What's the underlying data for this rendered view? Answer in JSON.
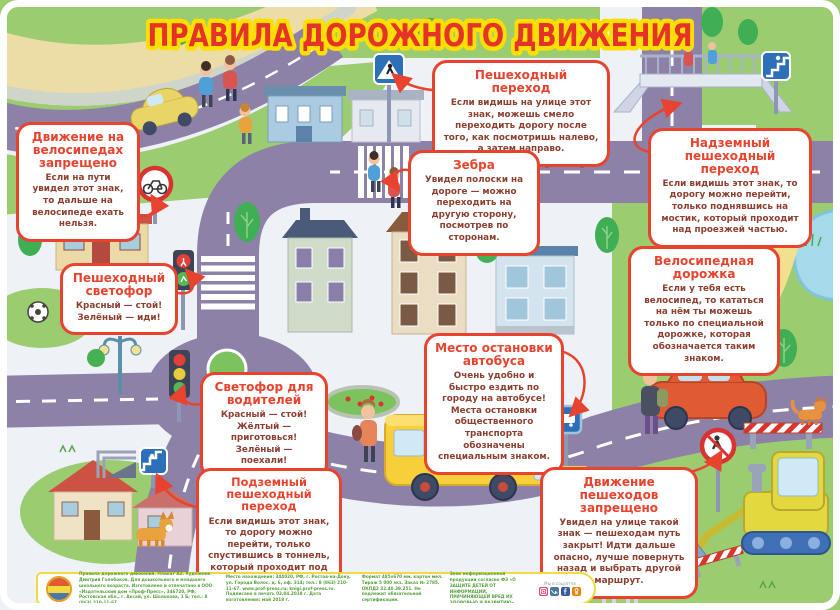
{
  "title": "ПРАВИЛА ДОРОЖНОГО ДВИЖЕНИЯ",
  "colors": {
    "accent_red": "#e8432e",
    "title_fill": "#e63329",
    "title_outline": "#ffdf00",
    "body_text": "#8c3f2f",
    "road": "#8d81a8",
    "grass": "#9bcc70",
    "footer_green": "#55a03c"
  },
  "callouts": {
    "no_bikes": {
      "title": "Движение на велосипедах запрещено",
      "body": "Если на пути увидел этот знак, то дальше на велосипеде ехать нельзя."
    },
    "crosswalk": {
      "title": "Пешеходный переход",
      "body": "Если видишь на улице этот знак, можешь смело переходить дорогу после того, как посмотришь налево, а затем направо."
    },
    "zebra": {
      "title": "Зебра",
      "body": "Увидел полоски на дороге — можно переходить на другую сторону, посмотрев по сторонам."
    },
    "overpass": {
      "title": "Надземный пешеходный переход",
      "body": "Если видишь этот знак, то дорогу можно перейти, только поднявшись на мостик, который проходит над проезжей частью."
    },
    "ped_light": {
      "title": "Пешеходный светофор",
      "body": "Красный — стой! Зелёный — иди!"
    },
    "bike_path": {
      "title": "Велосипедная дорожка",
      "body": "Если у тебя есть велосипед, то кататься на нём ты можешь только по специальной дорожке, которая обозначается таким знаком."
    },
    "bus_stop": {
      "title": "Место остановки автобуса",
      "body": "Очень удобно и быстро ездить по городу на автобусе! Места остановки общественного транспорта обозначены специальным знаком."
    },
    "driver_light": {
      "title": "Светофор для водителей",
      "body": "Красный — стой! Жёлтый — приготовься! Зелёный — поехали!"
    },
    "underpass": {
      "title": "Подземный пешеходный переход",
      "body": "Если видишь этот знак, то дорогу можно перейти, только спустившись в тоннель, который проходит под проезжей частью."
    },
    "no_peds": {
      "title": "Движение пешеходов запрещено",
      "body": "Увидел на улице такой знак — пешеходам путь закрыт! Идти дальше опасно, лучше повернуть назад и выбрать другой маршрут."
    }
  },
  "footer": {
    "col1": "Правила дорожного движения. Плакат А2. Художник Дмитрий Голобоков. Для дошкольного и младшего школьного возраста. Изготовлено и отпечатано в ООО «Издательский дом «Проф-Пресс», 346720, РФ, Ростовская обл., г. Аксай, ул. Шолохова, 1 Б; тел.: 8 (863) 210-11-67.",
    "col2": "Место нахождения: 344020, РФ, г. Ростов-на-Дону, ул. Города Волос, д. 6, оф. 314; тел.: 8 (863) 210-11-67. www.prof-press.ru; knigi.prof-press.ru. Подписано в печать 02.04.2018 г. Дата изготовления: май 2018 г.",
    "col3": "Формат 485х670 мм, картон мел. Тираж 5 000 экз. Заказ № 2785. ОКПД2 32.40.39.251. Не подлежит обязательной сертификации.",
    "col4": "Знак информационной продукции согласно ФЗ «О ЗАЩИТЕ ДЕТЕЙ ОТ ИНФОРМАЦИИ, ПРИЧИНЯЮЩЕЙ ВРЕД ИХ ЗДОРОВЬЮ И РАЗВИТИЮ»",
    "social_label": "Мы в соцсетях"
  },
  "icons": {
    "social": [
      "instagram-icon",
      "vk-icon",
      "facebook-icon",
      "odnoklassniki-icon"
    ]
  }
}
